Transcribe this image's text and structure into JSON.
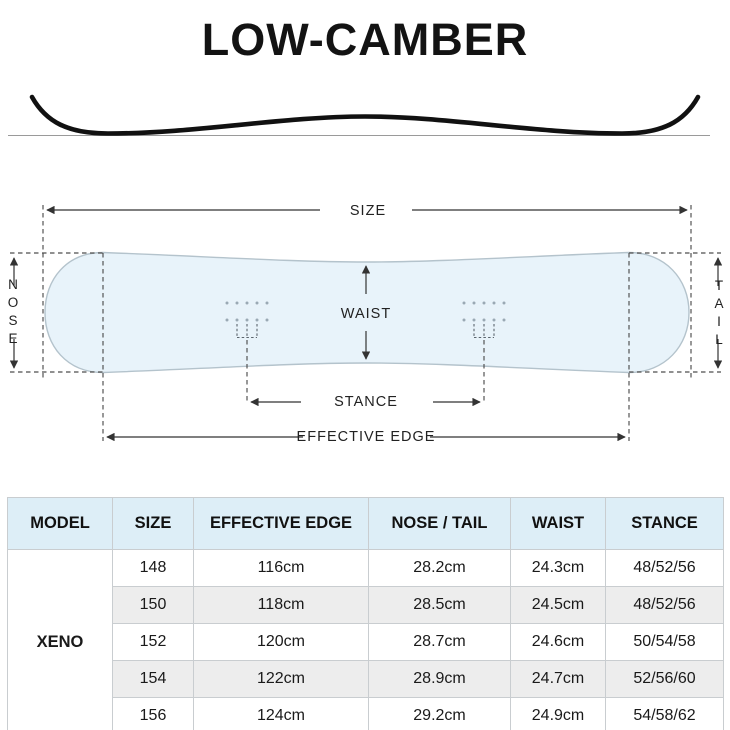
{
  "title": "LOW-CAMBER",
  "diagram": {
    "labels": {
      "size": "SIZE",
      "nose": "NOSE",
      "tail": "TAIL",
      "waist": "WAIST",
      "stance": "STANCE",
      "effective_edge": "EFFECTIVE EDGE"
    }
  },
  "colors": {
    "board_fill": "#e8f3fa",
    "board_outline": "#b4c3cc",
    "table_header_bg": "#ddeef7",
    "row_alt_bg": "#ededed",
    "table_border": "#c9cdd0",
    "line_dark": "#333333",
    "camber_line": "#111111",
    "baseline": "#9a9a9a"
  },
  "table": {
    "headers": [
      "MODEL",
      "SIZE",
      "EFFECTIVE EDGE",
      "NOSE / TAIL",
      "WAIST",
      "STANCE"
    ],
    "model": "XENO",
    "rows": [
      {
        "size": "148",
        "effective_edge": "116cm",
        "nose_tail": "28.2cm",
        "waist": "24.3cm",
        "stance": "48/52/56"
      },
      {
        "size": "150",
        "effective_edge": "118cm",
        "nose_tail": "28.5cm",
        "waist": "24.5cm",
        "stance": "48/52/56"
      },
      {
        "size": "152",
        "effective_edge": "120cm",
        "nose_tail": "28.7cm",
        "waist": "24.6cm",
        "stance": "50/54/58"
      },
      {
        "size": "154",
        "effective_edge": "122cm",
        "nose_tail": "28.9cm",
        "waist": "24.7cm",
        "stance": "52/56/60"
      },
      {
        "size": "156",
        "effective_edge": "124cm",
        "nose_tail": "29.2cm",
        "waist": "24.9cm",
        "stance": "54/58/62"
      }
    ]
  }
}
